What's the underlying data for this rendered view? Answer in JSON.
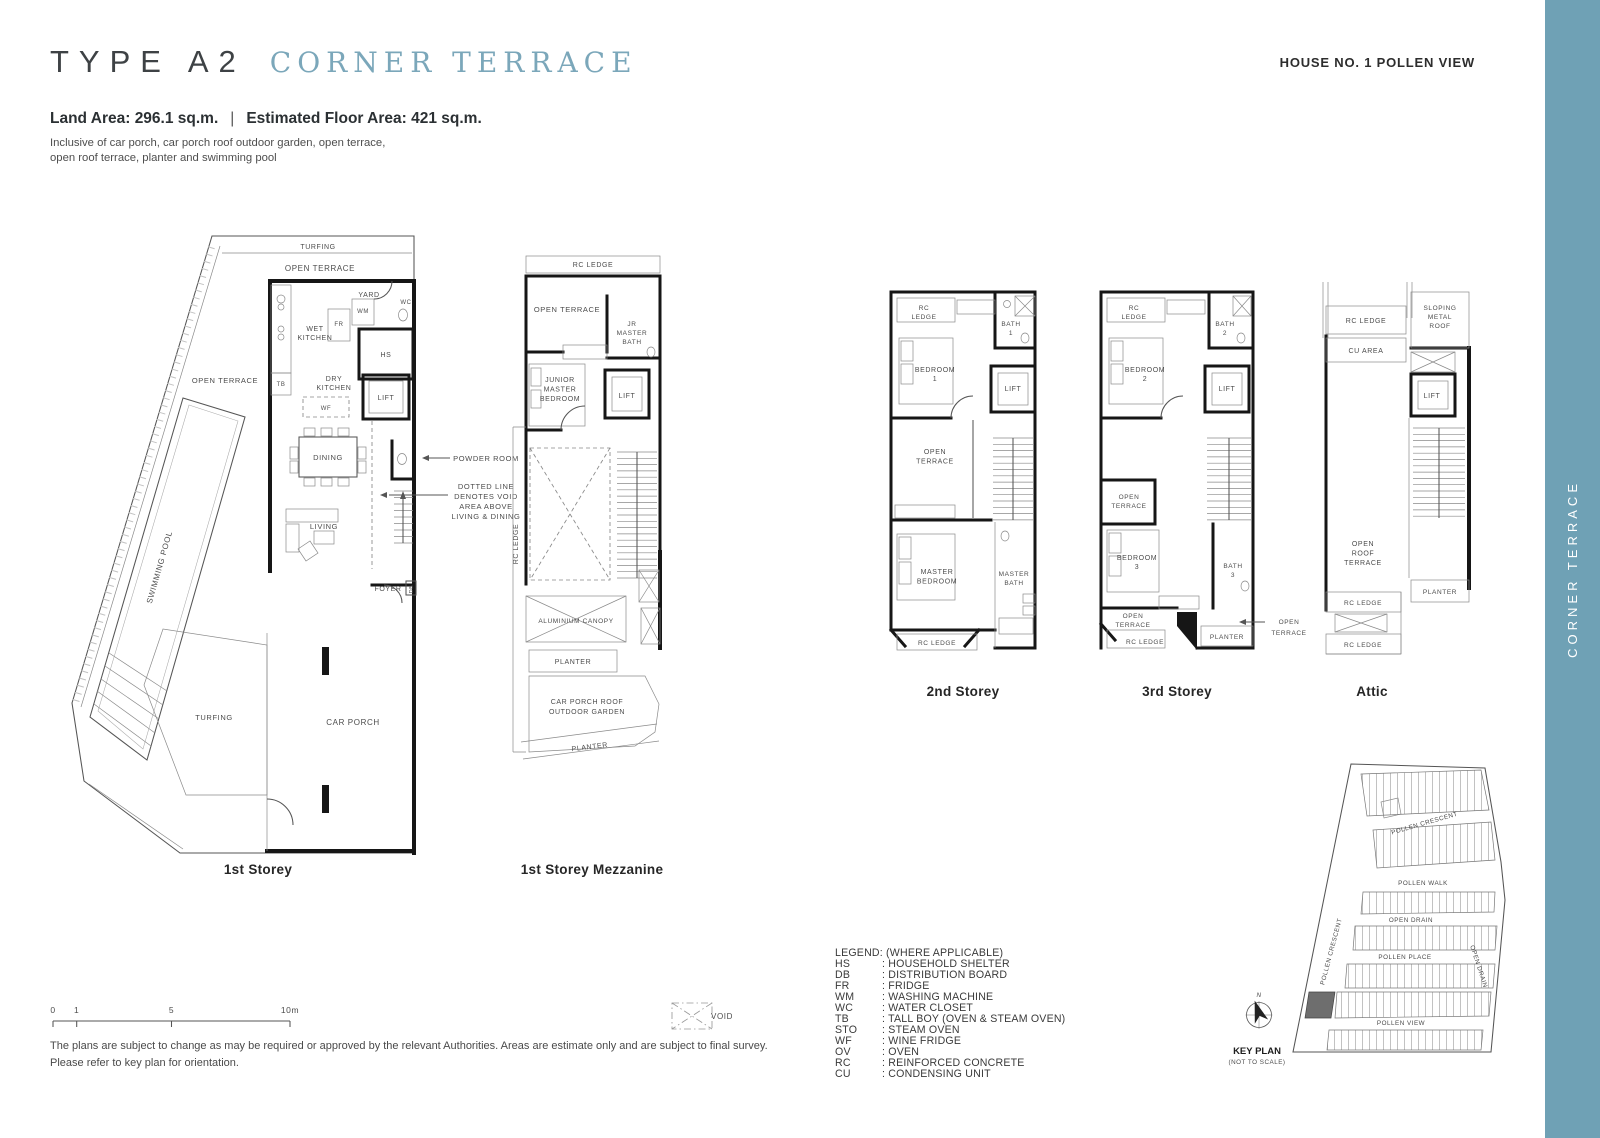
{
  "colors": {
    "accent": "#7BA7BA",
    "banner": "#6FA1B5",
    "ink": "#3E4245"
  },
  "header": {
    "type_label": "TYPE A2",
    "type_name": "CORNER TERRACE",
    "house_no": "HOUSE NO. 1 POLLEN VIEW",
    "land_area": "Land Area: 296.1 sq.m.",
    "separator": "|",
    "floor_area": "Estimated Floor Area: 421 sq.m.",
    "inclusive_line1": "Inclusive of car porch, car porch roof outdoor garden, open terrace,",
    "inclusive_line2": "open roof terrace, planter and swimming pool"
  },
  "banner": {
    "text": "CORNER TERRACE"
  },
  "plans": {
    "first_storey": {
      "caption": "1st Storey",
      "labels": {
        "turfing_top": "TURFING",
        "open_terrace_top": "OPEN TERRACE",
        "yard": "YARD",
        "wc": "WC",
        "wm": "WM",
        "fr": "FR",
        "wet_kitchen": "WET\nKITCHEN",
        "hs": "HS",
        "tb": "TB",
        "dry_kitchen": "DRY\nKITCHEN",
        "lift": "LIFT",
        "wf": "WF",
        "open_terrace_left": "OPEN TERRACE",
        "dining": "DINING",
        "powder_room": "POWDER ROOM",
        "void_note": "DOTTED LINE\nDENOTES VOID\nAREA ABOVE\nLIVING & DINING",
        "living": "LIVING",
        "foyer": "FOYER",
        "db": "DB",
        "swimming_pool": "SWIMMING POOL",
        "turfing_bottom": "TURFING",
        "car_porch": "CAR PORCH"
      }
    },
    "mezzanine": {
      "caption": "1st Storey Mezzanine",
      "labels": {
        "rc_ledge_top": "RC LEDGE",
        "open_terrace": "OPEN TERRACE",
        "jr_master_bath": "JR\nMASTER\nBATH",
        "junior_master_bedroom": "JUNIOR\nMASTER\nBEDROOM",
        "lift": "LIFT",
        "rc_ledge_left": "RC LEDGE",
        "aluminium_canopy": "ALUMINIUM CANOPY",
        "planter_mid": "PLANTER",
        "car_porch_roof": "CAR PORCH ROOF\nOUTDOOR GARDEN",
        "planter_bottom": "PLANTER"
      }
    },
    "second_storey": {
      "caption": "2nd Storey",
      "labels": {
        "rc_ledge_top": "RC\nLEDGE",
        "bath1": "BATH\n1",
        "bedroom1": "BEDROOM\n1",
        "lift": "LIFT",
        "open_terrace": "OPEN\nTERRACE",
        "master_bedroom": "MASTER\nBEDROOM",
        "master_bath": "MASTER\nBATH",
        "rc_ledge_bottom": "RC LEDGE"
      }
    },
    "third_storey": {
      "caption": "3rd Storey",
      "labels": {
        "rc_ledge_top": "RC\nLEDGE",
        "bath2": "BATH\n2",
        "bedroom2": "BEDROOM\n2",
        "lift": "LIFT",
        "open_terrace_mid": "OPEN\nTERRACE",
        "bedroom3": "BEDROOM\n3",
        "bath3": "BATH\n3",
        "open_terrace_low": "OPEN\nTERRACE",
        "rc_ledge_bottom": "RC LEDGE",
        "planter": "PLANTER",
        "open_terrace_callout": "OPEN\nTERRACE"
      }
    },
    "attic": {
      "caption": "Attic",
      "labels": {
        "rc_ledge_top": "RC LEDGE",
        "sloping_roof": "SLOPING\nMETAL\nROOF",
        "cu_area": "CU AREA",
        "lift": "LIFT",
        "open_roof_terrace": "OPEN\nROOF\nTERRACE",
        "planter": "PLANTER",
        "rc_ledge_mid": "RC LEDGE",
        "rc_ledge_bottom": "RC LEDGE"
      }
    }
  },
  "legend": {
    "title": "LEGEND: (WHERE APPLICABLE)",
    "items": [
      {
        "abbr": "HS",
        "desc": "HOUSEHOLD SHELTER"
      },
      {
        "abbr": "DB",
        "desc": "DISTRIBUTION BOARD"
      },
      {
        "abbr": "FR",
        "desc": "FRIDGE"
      },
      {
        "abbr": "WM",
        "desc": "WASHING MACHINE"
      },
      {
        "abbr": "WC",
        "desc": "WATER CLOSET"
      },
      {
        "abbr": "TB",
        "desc": "TALL BOY (OVEN & STEAM OVEN)"
      },
      {
        "abbr": "STO",
        "desc": "STEAM OVEN"
      },
      {
        "abbr": "WF",
        "desc": "WINE FRIDGE"
      },
      {
        "abbr": "OV",
        "desc": "OVEN"
      },
      {
        "abbr": "RC",
        "desc": "REINFORCED CONCRETE"
      },
      {
        "abbr": "CU",
        "desc": "CONDENSING UNIT"
      }
    ]
  },
  "scale_bar": {
    "ticks": [
      "0",
      "1",
      "5",
      "10m"
    ]
  },
  "void_symbol": {
    "label": "VOID"
  },
  "key_plan": {
    "title": "KEY PLAN",
    "note": "(NOT TO SCALE)",
    "north": "N",
    "streets": {
      "crescent_top": "POLLEN CRESCENT",
      "walk": "POLLEN WALK",
      "drain_mid": "OPEN DRAIN",
      "place": "POLLEN PLACE",
      "view": "POLLEN VIEW",
      "crescent_left": "POLLEN CRESCENT",
      "drain_right": "OPEN DRAIN"
    }
  },
  "disclaimer": {
    "line1": "The plans are subject to change as may be required or approved by the relevant Authorities. Areas are estimate only and are subject to final survey.",
    "line2": "Please refer to key plan for orientation."
  }
}
